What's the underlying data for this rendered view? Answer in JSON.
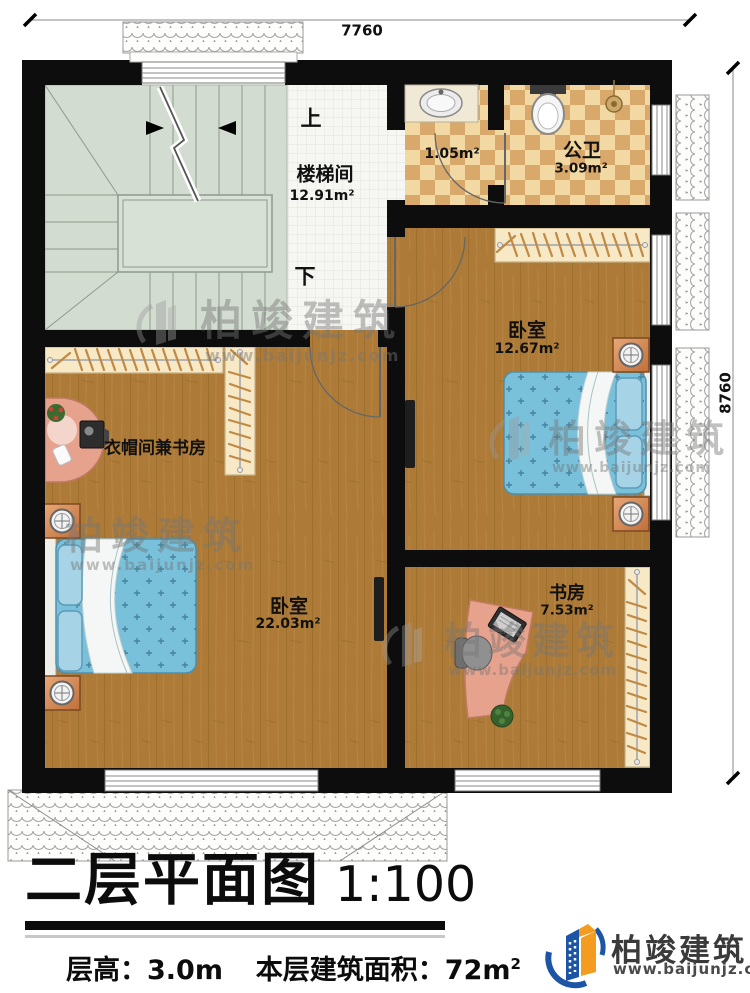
{
  "dimensions": {
    "top": "7760",
    "right": "8760"
  },
  "stairwell": {
    "label": "楼梯间",
    "area": "12.91m²",
    "up": "上",
    "down": "下"
  },
  "bath": {
    "lobby_area": "1.05m²",
    "name": "公卫",
    "area": "3.09m²"
  },
  "bedroom_right": {
    "name": "卧室",
    "area": "12.67m²"
  },
  "cloakroom": {
    "name": "衣帽间兼书房"
  },
  "bedroom_main": {
    "name": "卧室",
    "area": "22.03m²"
  },
  "study": {
    "name": "书房",
    "area": "7.53m²"
  },
  "watermark": {
    "brand": "柏竣建筑",
    "site": "www.baijunjz.com"
  },
  "title_block": {
    "title": "二层平面图",
    "scale": "1:100",
    "floor_height": "层高：3.0m",
    "floor_area_prefix": "本层建筑面积：72m",
    "floor_area_sup": "2"
  },
  "logo": {
    "brand": "柏竣建筑",
    "site": "www.baijunjz.com"
  },
  "colors": {
    "wall": "#0d0d0d",
    "wood_floor": "#ab7a38",
    "stair_floor": "#d2dcd0",
    "checker_light": "#f2d9a3",
    "checker_dark": "#d9a96b",
    "bed_blue": "#79c0da",
    "wardrobe_cream": "#f7e8c6",
    "desk_salmon": "#e7a28d",
    "logo_blue": "#1c55a5",
    "logo_orange": "#f39c1f"
  }
}
